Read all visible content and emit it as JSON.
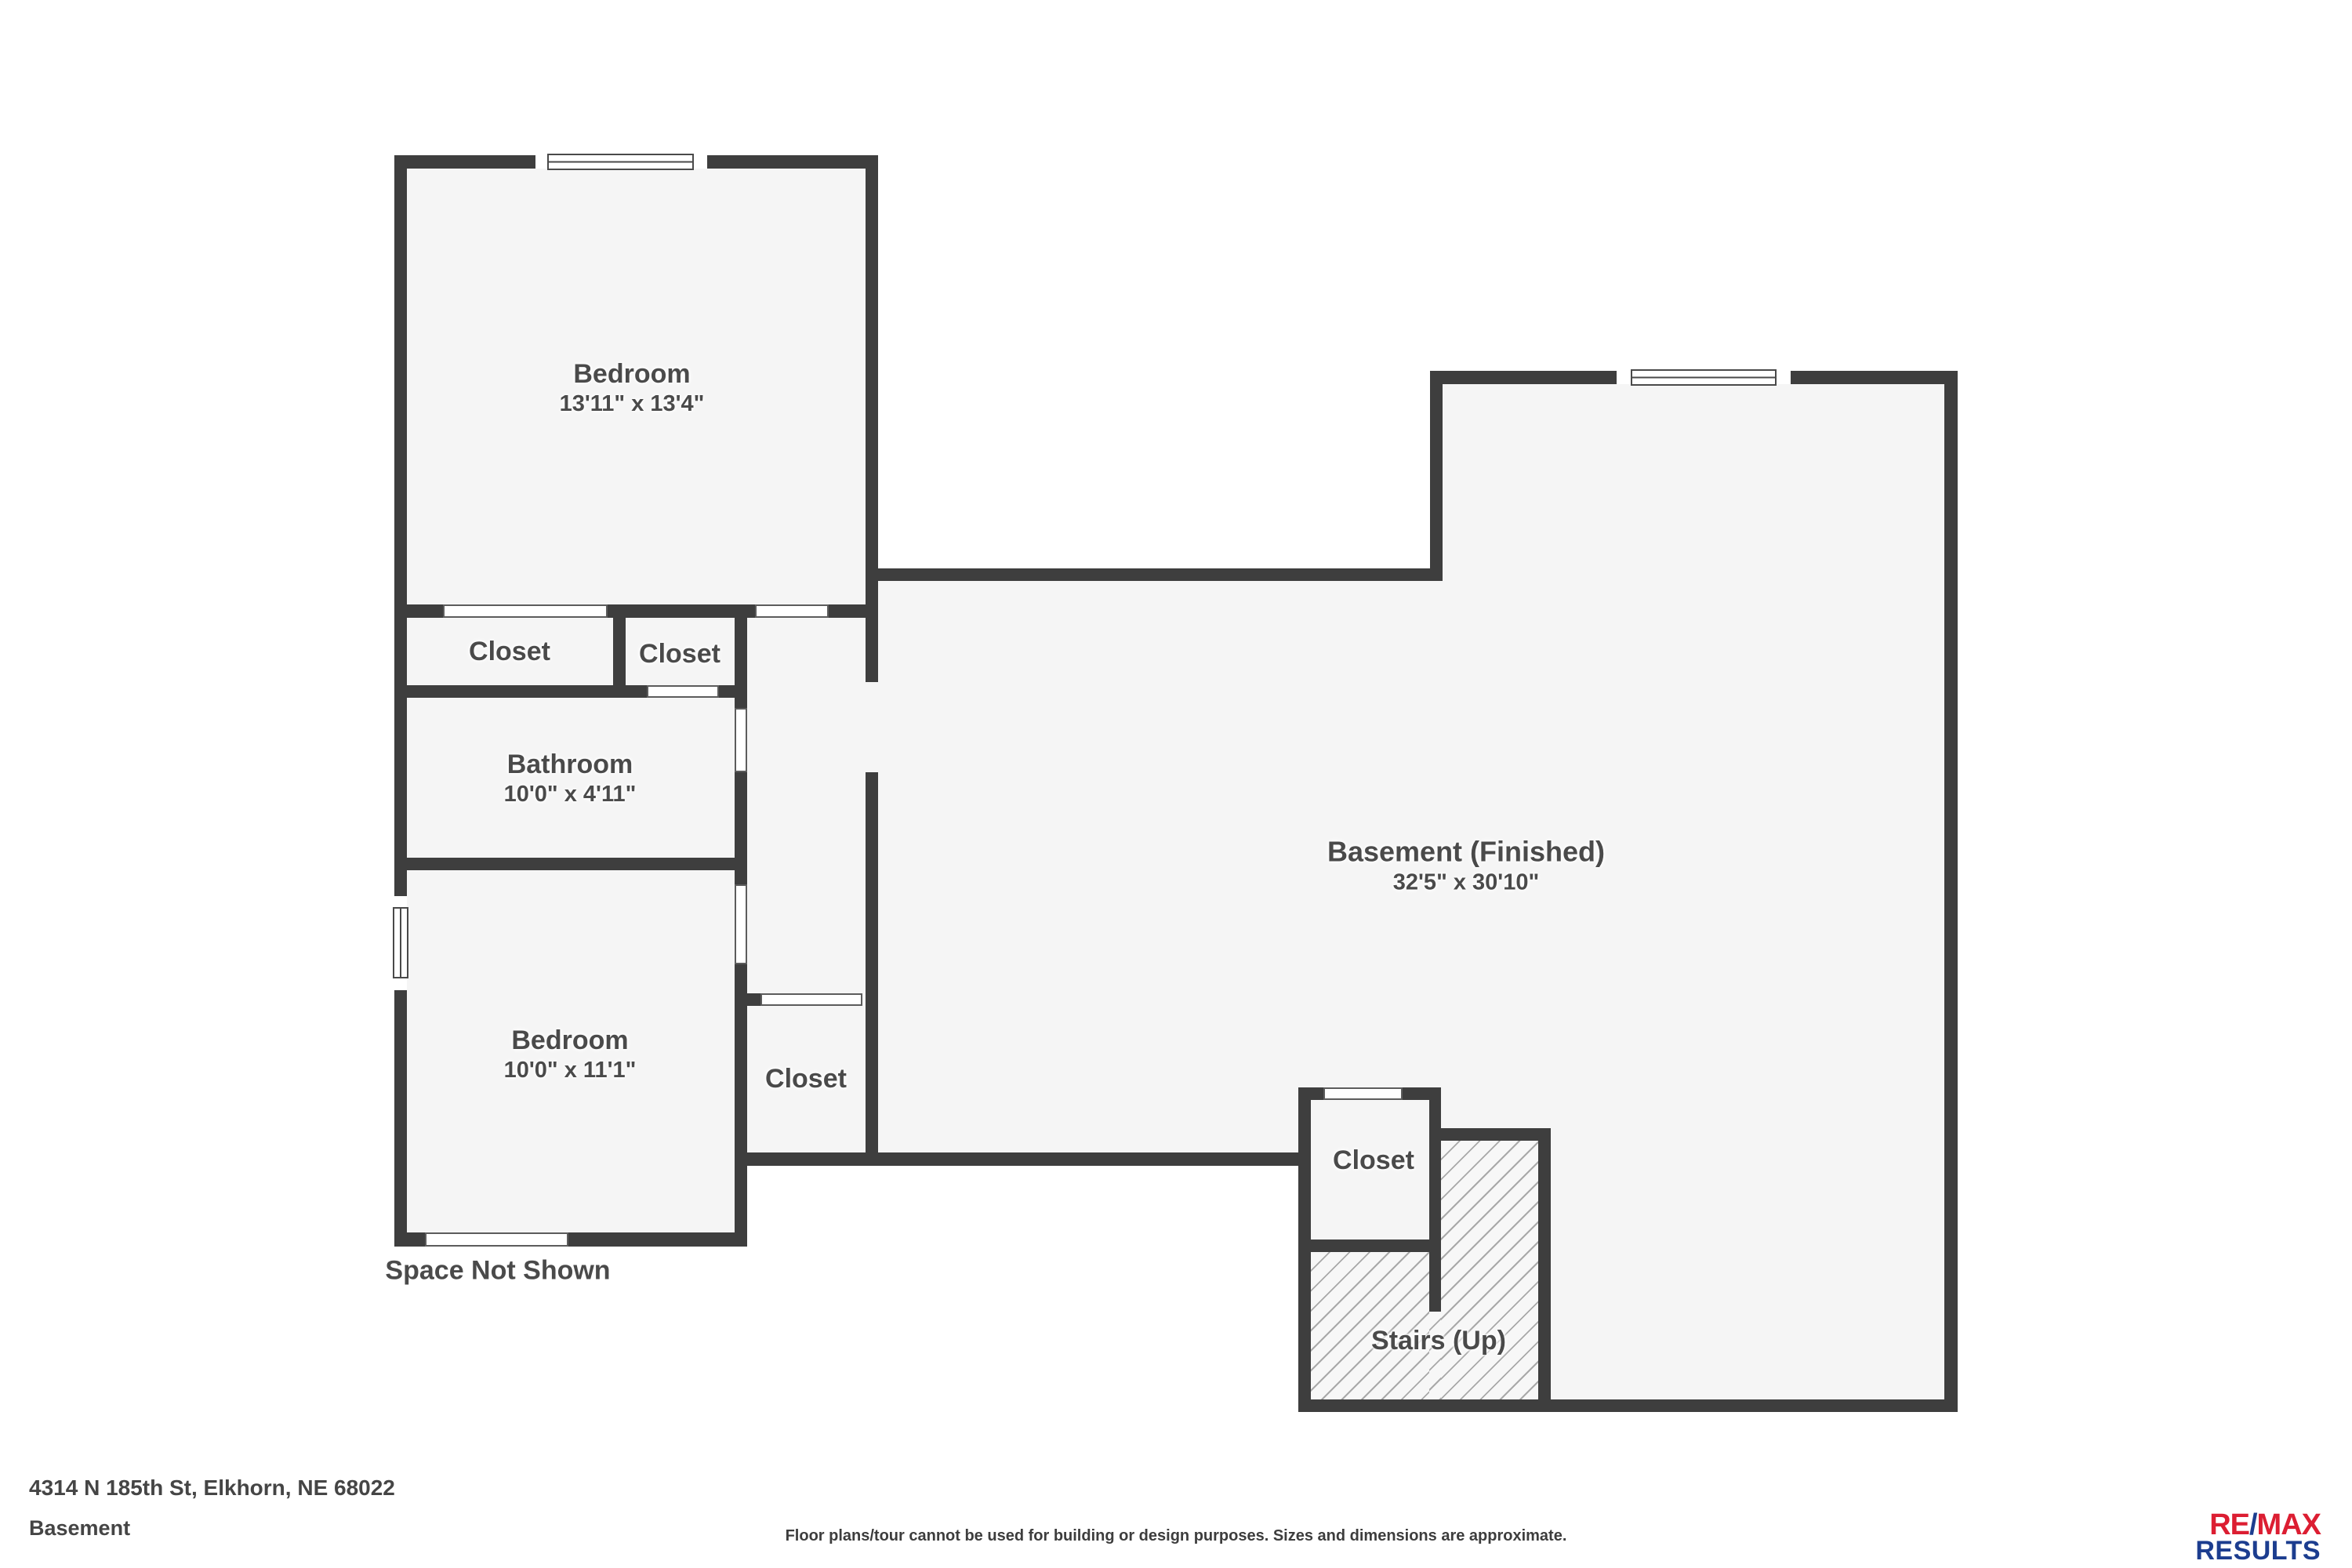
{
  "plan": {
    "rooms": {
      "bedroom1": {
        "name": "Bedroom",
        "dims": "13'11\" x 13'4\""
      },
      "closet_left": {
        "name": "Closet"
      },
      "closet_right": {
        "name": "Closet"
      },
      "bathroom": {
        "name": "Bathroom",
        "dims": "10'0\" x 4'11\""
      },
      "bedroom2": {
        "name": "Bedroom",
        "dims": "10'0\" x 11'1\""
      },
      "closet_middle": {
        "name": "Closet"
      },
      "basement": {
        "name": "Basement (Finished)",
        "dims": "32'5\" x 30'10\""
      },
      "closet_stairs": {
        "name": "Closet"
      },
      "stairs": {
        "name": "Stairs (Up)"
      }
    },
    "annotations": {
      "space_not_shown": "Space Not Shown"
    }
  },
  "footer": {
    "address": "4314 N 185th St, Elkhorn, NE 68022",
    "level": "Basement",
    "disclaimer": "Floor plans/tour cannot be used for building or design purposes. Sizes and dimensions are approximate.",
    "logo": {
      "re": "RE",
      "slash": "/",
      "max": "MAX",
      "results": "RESULTS"
    }
  },
  "colors": {
    "wall": "#3e3e3e",
    "room_fill": "#f5f5f5",
    "hatch_line": "#a9a9a9",
    "label_text": "#4a4a4a",
    "remax_red": "#dc1e32",
    "remax_blue": "#1c3d8f"
  }
}
